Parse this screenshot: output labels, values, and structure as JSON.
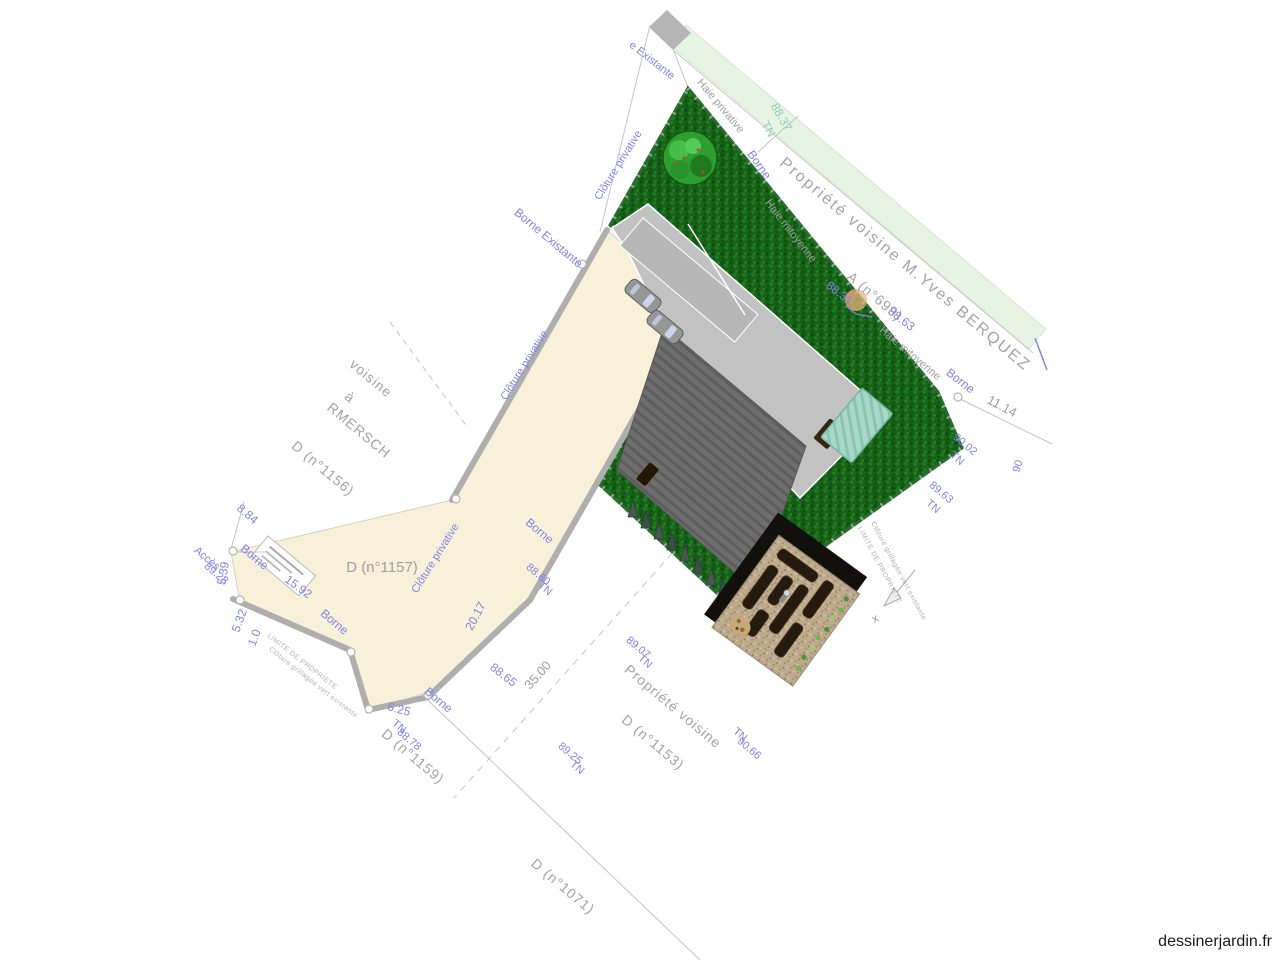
{
  "site": {
    "watermark": "dessinerjardin.fr"
  },
  "neighbors": {
    "berquez": {
      "line1": "Propriété voisine  M.Yves BERQUEZ",
      "line2": "A (n°699)"
    },
    "rmersch": {
      "line1": "voisine",
      "line2": "à",
      "line3": "RMERSCH",
      "line4": "D (n°1156)"
    },
    "d1157": "D (n°1157)",
    "d1159": "D (n°1159)",
    "d1071": "D (n°1071)",
    "d1153": {
      "line1": "Propriété voisine",
      "line2": "D (n°1153)"
    }
  },
  "boundaries": {
    "borne": "Borne",
    "borne_existante": "Borne Existante",
    "e_existante": "e Existante",
    "cloture_privative": "Clôture privative",
    "haie_privative": "Haie privative",
    "haie_mitoyenne": "Haie mitoyenne",
    "limite_de_propriete": "LIMITE DE PROPRIETE",
    "cloture_grillagee": "Clôture  grillagée vert existante",
    "acces": "Accès",
    "x_marker": "x"
  },
  "dimensions": {
    "d8_84": "8.84",
    "d15_92": "15.92",
    "d6_25": "6.25",
    "d20_17": "20.17",
    "d5_39": "5.39",
    "d5_32": "5.32",
    "d1_0": "1.0",
    "d11_14": "11.14",
    "d35_00": "35.00"
  },
  "levels": {
    "tn": "TN",
    "v88_37": "88.37",
    "v88_31": "88.31",
    "v88_63": "88.63",
    "v90_02": "90.02",
    "v89_63": "89.63",
    "v88_60": "88.60",
    "v88_65": "88.65",
    "v89_07": "89.07",
    "v89_25": "89.25",
    "v88_78": "88.78",
    "v90_66": "90.66",
    "v89_28": "89.28",
    "v90": "90"
  },
  "palette": {
    "lawn_green": "#186218",
    "hedge_strip_green": "#e7f3e3",
    "driveway_cream": "#f8f1da",
    "house_gray": "#c2c2c2",
    "terrace_gray": "#6e6e6e",
    "greenhouse_teal": "#a8d8c8",
    "planter_soil": "#241a0e",
    "gravel_sand": "#bda98c",
    "label_blue": "#8282e8",
    "label_gray": "#9e9e9e"
  }
}
